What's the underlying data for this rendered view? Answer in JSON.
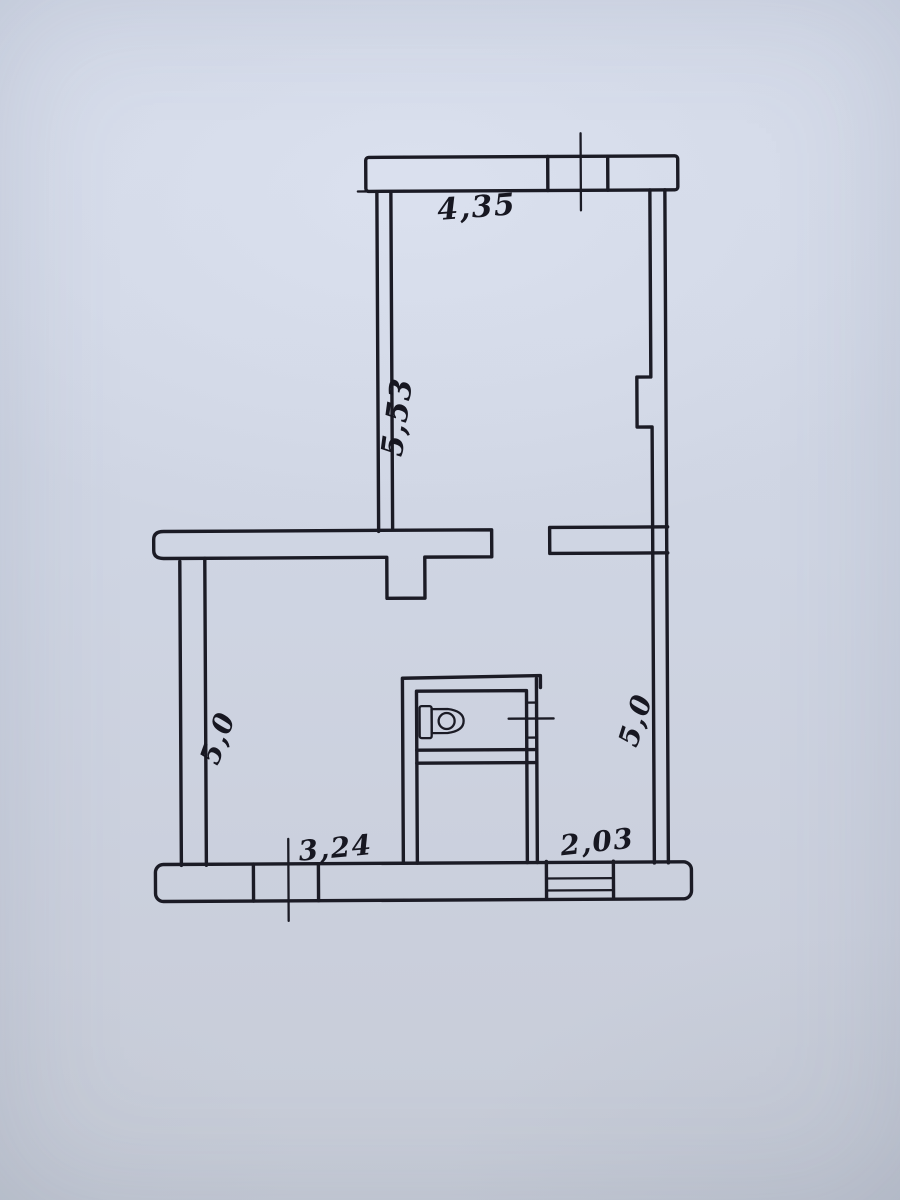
{
  "page": {
    "paper_color": "#cfd5e3",
    "ink_color": "#1b1b25"
  },
  "floorplan": {
    "dimensions": {
      "top_width": "4,35",
      "upper_room_depth": "5,53",
      "lower_left_room_depth": "5,0",
      "lower_right_room_depth": "5,0",
      "bottom_left_width": "3,24",
      "bottom_right_width": "2,03"
    }
  }
}
